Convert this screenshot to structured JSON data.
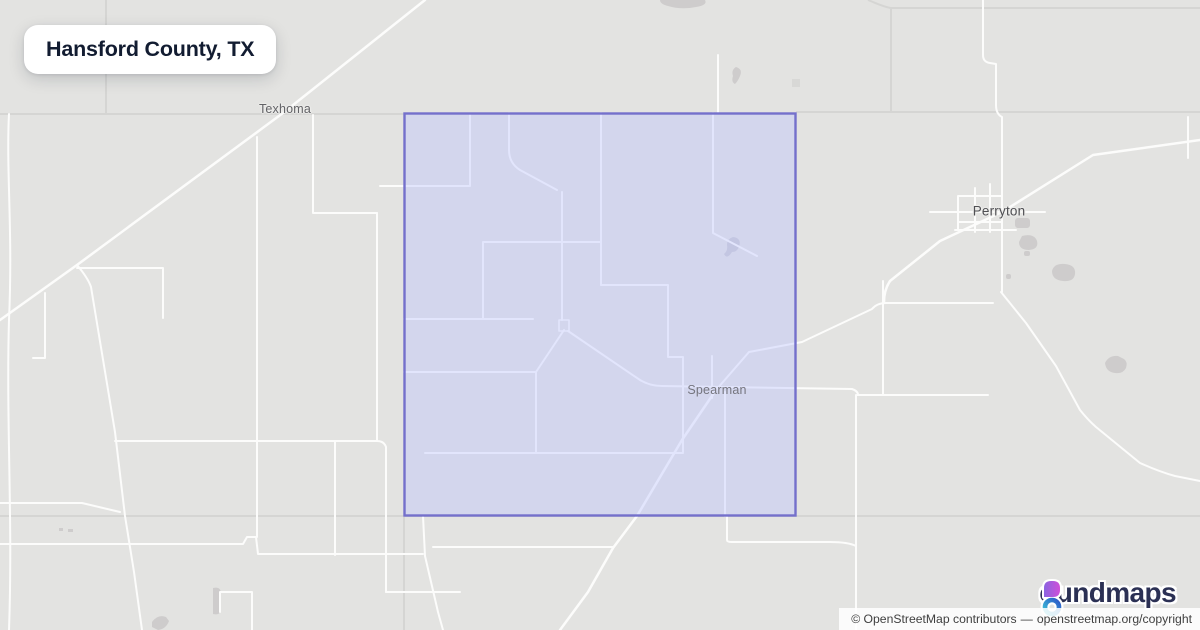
{
  "page": {
    "title_badge": "Hansford County, TX"
  },
  "map": {
    "county": {
      "name": "Hansford County",
      "state": "TX",
      "border_color": "#7470cb",
      "fill_rgba": "rgba(187,195,255,0.40)"
    },
    "city_labels": [
      {
        "name": "Texhoma",
        "x": 285,
        "y": 109,
        "style": ""
      },
      {
        "name": "Perryton",
        "x": 999,
        "y": 211,
        "style": "big"
      },
      {
        "name": "Spearman",
        "x": 717,
        "y": 390,
        "style": "in-county"
      }
    ],
    "colors": {
      "background": "#e3e3e1",
      "road": "#fcfcfb",
      "admin_boundary": "#d5d5d3",
      "urban_area": "#cecccc"
    }
  },
  "logo": {
    "brand": "boundmaps",
    "wordmark_rest": "oundmaps",
    "icon": "b-drop-and-ring",
    "text_color": "#2b3054",
    "drop_gradient": [
      "#8a63e0",
      "#cf4ed8"
    ],
    "ring_gradient": [
      "#3fc6d8",
      "#2b57c8"
    ]
  },
  "attribution": {
    "prefix": "© OpenStreetMap contributors",
    "separator": "—",
    "link": "openstreetmap.org/copyright"
  }
}
